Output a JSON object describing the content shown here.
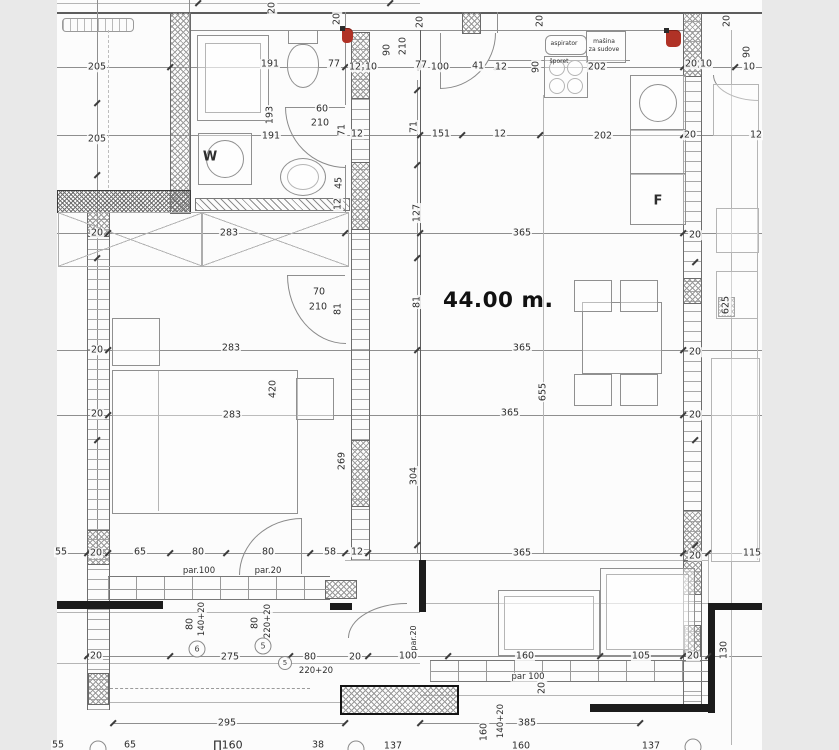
{
  "title": "apartment floor plan",
  "area": {
    "text": "44.00 m",
    "suffix": "."
  },
  "room_marks": {
    "washing_machine": "W",
    "fridge": "F"
  },
  "kitchen": {
    "hood": "aspirator",
    "dishwasher_line1": "mašina",
    "dishwasher_line2": "za sudove",
    "stove": "šporet"
  },
  "colors": {
    "paper": "#fcfcfc",
    "mat": "#e9e9e9",
    "line": "#8f8f8f",
    "wall_dark": "#1c1c1c",
    "red_mark": "#b03226"
  },
  "dimension_labels": [
    {
      "t": "20",
      "x": 272,
      "y": 8,
      "v": 1
    },
    {
      "t": "20",
      "x": 337,
      "y": 19,
      "v": 1
    },
    {
      "t": "20",
      "x": 420,
      "y": 22,
      "v": 1
    },
    {
      "t": "20",
      "x": 540,
      "y": 21,
      "v": 1
    },
    {
      "t": "20",
      "x": 727,
      "y": 21,
      "v": 1
    },
    {
      "t": "205",
      "x": 97,
      "y": 67
    },
    {
      "t": "191",
      "x": 270,
      "y": 64
    },
    {
      "t": "77",
      "x": 334,
      "y": 64
    },
    {
      "t": "12",
      "x": 355,
      "y": 67
    },
    {
      "t": "10",
      "x": 371,
      "y": 67
    },
    {
      "t": "90",
      "x": 387,
      "y": 50,
      "v": 1
    },
    {
      "t": "210",
      "x": 403,
      "y": 46,
      "v": 1
    },
    {
      "t": "77",
      "x": 421,
      "y": 65
    },
    {
      "t": "100",
      "x": 440,
      "y": 67
    },
    {
      "t": "41",
      "x": 478,
      "y": 66
    },
    {
      "t": "12",
      "x": 501,
      "y": 67
    },
    {
      "t": "90",
      "x": 536,
      "y": 67,
      "v": 1
    },
    {
      "t": "202",
      "x": 597,
      "y": 67
    },
    {
      "t": "20",
      "x": 691,
      "y": 64
    },
    {
      "t": "10",
      "x": 706,
      "y": 64
    },
    {
      "t": "90",
      "x": 747,
      "y": 52,
      "v": 1
    },
    {
      "t": "10",
      "x": 749,
      "y": 67
    },
    {
      "t": "aspirator",
      "x": 564,
      "y": 44,
      "s": 6,
      "nobg": 1
    },
    {
      "t": "mašina",
      "x": 604,
      "y": 42,
      "s": 6,
      "nobg": 1
    },
    {
      "t": "za sudove",
      "x": 604,
      "y": 50,
      "s": 6,
      "nobg": 1
    },
    {
      "t": "šporet",
      "x": 559,
      "y": 62,
      "s": 6,
      "nobg": 1
    },
    {
      "t": "60",
      "x": 322,
      "y": 109
    },
    {
      "t": "210",
      "x": 320,
      "y": 123
    },
    {
      "t": "71",
      "x": 342,
      "y": 130,
      "v": 1
    },
    {
      "t": "193",
      "x": 270,
      "y": 115,
      "v": 1
    },
    {
      "t": "191",
      "x": 271,
      "y": 136
    },
    {
      "t": "45",
      "x": 339,
      "y": 183,
      "v": 1
    },
    {
      "t": "12",
      "x": 338,
      "y": 204,
      "v": 1
    },
    {
      "t": "205",
      "x": 97,
      "y": 139
    },
    {
      "t": "12",
      "x": 357,
      "y": 134
    },
    {
      "t": "151",
      "x": 441,
      "y": 134
    },
    {
      "t": "12",
      "x": 500,
      "y": 134
    },
    {
      "t": "202",
      "x": 603,
      "y": 136
    },
    {
      "t": "20",
      "x": 690,
      "y": 135
    },
    {
      "t": "12",
      "x": 756,
      "y": 135
    },
    {
      "t": "W",
      "x": 210,
      "y": 157,
      "s": 13,
      "b": 1,
      "nobg": 1
    },
    {
      "t": "F",
      "x": 658,
      "y": 201,
      "s": 13,
      "b": 1,
      "nobg": 1
    },
    {
      "t": "71",
      "x": 414,
      "y": 127,
      "v": 1
    },
    {
      "t": "127",
      "x": 417,
      "y": 213,
      "v": 1
    },
    {
      "t": "81",
      "x": 417,
      "y": 302,
      "v": 1
    },
    {
      "t": "304",
      "x": 414,
      "y": 476,
      "v": 1
    },
    {
      "t": "269",
      "x": 342,
      "y": 461,
      "v": 1
    },
    {
      "t": "420",
      "x": 273,
      "y": 389,
      "v": 1
    },
    {
      "t": "20",
      "x": 97,
      "y": 233
    },
    {
      "t": "20",
      "x": 97,
      "y": 350
    },
    {
      "t": "20",
      "x": 97,
      "y": 414
    },
    {
      "t": "283",
      "x": 229,
      "y": 233
    },
    {
      "t": "283",
      "x": 231,
      "y": 348
    },
    {
      "t": "283",
      "x": 232,
      "y": 415
    },
    {
      "t": "70",
      "x": 319,
      "y": 292
    },
    {
      "t": "210",
      "x": 318,
      "y": 307
    },
    {
      "t": "81",
      "x": 338,
      "y": 309,
      "v": 1
    },
    {
      "t": "365",
      "x": 522,
      "y": 233
    },
    {
      "t": "365",
      "x": 522,
      "y": 348
    },
    {
      "t": "365",
      "x": 510,
      "y": 413
    },
    {
      "t": "365",
      "x": 522,
      "y": 553
    },
    {
      "t": "655",
      "x": 543,
      "y": 392,
      "v": 1
    },
    {
      "t": "20",
      "x": 695,
      "y": 235
    },
    {
      "t": "20",
      "x": 695,
      "y": 352
    },
    {
      "t": "20",
      "x": 695,
      "y": 415
    },
    {
      "t": "625",
      "x": 726,
      "y": 305,
      "v": 1
    },
    {
      "t": "55",
      "x": 61,
      "y": 552
    },
    {
      "t": "20",
      "x": 96,
      "y": 553
    },
    {
      "t": "65",
      "x": 140,
      "y": 552
    },
    {
      "t": "80",
      "x": 198,
      "y": 552
    },
    {
      "t": "80",
      "x": 268,
      "y": 552
    },
    {
      "t": "58",
      "x": 330,
      "y": 552
    },
    {
      "t": "12",
      "x": 357,
      "y": 552
    },
    {
      "t": "20",
      "x": 695,
      "y": 556
    },
    {
      "t": "115",
      "x": 752,
      "y": 553
    },
    {
      "t": "par.100",
      "x": 199,
      "y": 571,
      "s": 8.5
    },
    {
      "t": "par.20",
      "x": 268,
      "y": 571,
      "s": 8.5
    },
    {
      "t": "80",
      "x": 190,
      "y": 624,
      "v": 1
    },
    {
      "t": "140+20",
      "x": 202,
      "y": 619,
      "v": 1,
      "s": 8.5
    },
    {
      "t": "80",
      "x": 255,
      "y": 623,
      "v": 1
    },
    {
      "t": "220+20",
      "x": 268,
      "y": 621,
      "v": 1,
      "s": 8.5
    },
    {
      "t": "275",
      "x": 230,
      "y": 657
    },
    {
      "t": "80",
      "x": 310,
      "y": 657
    },
    {
      "t": "220+20",
      "x": 316,
      "y": 671,
      "s": 8.5
    },
    {
      "t": "20",
      "x": 96,
      "y": 656
    },
    {
      "t": "20",
      "x": 355,
      "y": 657
    },
    {
      "t": "100",
      "x": 408,
      "y": 656
    },
    {
      "t": "par.20",
      "x": 414,
      "y": 638,
      "v": 1,
      "s": 8
    },
    {
      "t": "160",
      "x": 525,
      "y": 656
    },
    {
      "t": "105",
      "x": 641,
      "y": 656
    },
    {
      "t": "20",
      "x": 693,
      "y": 656
    },
    {
      "t": "130",
      "x": 724,
      "y": 650,
      "v": 1
    },
    {
      "t": "par 100",
      "x": 528,
      "y": 677,
      "s": 8.5
    },
    {
      "t": "20",
      "x": 542,
      "y": 688,
      "v": 1
    },
    {
      "t": "295",
      "x": 227,
      "y": 723
    },
    {
      "t": "385",
      "x": 527,
      "y": 723
    },
    {
      "t": "140+20",
      "x": 501,
      "y": 721,
      "v": 1,
      "s": 8.5
    },
    {
      "t": "160",
      "x": 484,
      "y": 732,
      "v": 1
    },
    {
      "t": "55",
      "x": 58,
      "y": 745
    },
    {
      "t": "65",
      "x": 130,
      "y": 745
    },
    {
      "t": "∏160",
      "x": 228,
      "y": 745,
      "s": 11
    },
    {
      "t": "38",
      "x": 318,
      "y": 745
    },
    {
      "t": "137",
      "x": 393,
      "y": 746
    },
    {
      "t": "160",
      "x": 521,
      "y": 746
    },
    {
      "t": "137",
      "x": 651,
      "y": 746
    }
  ],
  "circled_marks": [
    {
      "t": "6",
      "x": 197,
      "y": 649
    },
    {
      "t": "5",
      "x": 263,
      "y": 646
    },
    {
      "t": "5",
      "x": 285,
      "y": 663,
      "small": 1
    },
    {
      "t": "",
      "x": 98,
      "y": 749
    },
    {
      "t": "",
      "x": 356,
      "y": 749
    },
    {
      "t": "",
      "x": 693,
      "y": 747
    }
  ],
  "ticks": [
    {
      "x": 170,
      "y": 67
    },
    {
      "x": 345,
      "y": 67
    },
    {
      "x": 420,
      "y": 67
    },
    {
      "x": 497,
      "y": 67
    },
    {
      "x": 683,
      "y": 67
    },
    {
      "x": 735,
      "y": 67
    },
    {
      "x": 420,
      "y": 135
    },
    {
      "x": 462,
      "y": 135
    },
    {
      "x": 540,
      "y": 135
    },
    {
      "x": 683,
      "y": 135
    },
    {
      "x": 108,
      "y": 233
    },
    {
      "x": 345,
      "y": 233
    },
    {
      "x": 420,
      "y": 233
    },
    {
      "x": 683,
      "y": 233
    },
    {
      "x": 108,
      "y": 350
    },
    {
      "x": 683,
      "y": 350
    },
    {
      "x": 108,
      "y": 415
    },
    {
      "x": 683,
      "y": 415
    },
    {
      "x": 87,
      "y": 553
    },
    {
      "x": 108,
      "y": 553
    },
    {
      "x": 170,
      "y": 553
    },
    {
      "x": 226,
      "y": 553
    },
    {
      "x": 310,
      "y": 553
    },
    {
      "x": 345,
      "y": 553
    },
    {
      "x": 368,
      "y": 553
    },
    {
      "x": 683,
      "y": 553
    },
    {
      "x": 708,
      "y": 553
    },
    {
      "x": 87,
      "y": 656
    },
    {
      "x": 170,
      "y": 656
    },
    {
      "x": 290,
      "y": 656
    },
    {
      "x": 368,
      "y": 656
    },
    {
      "x": 448,
      "y": 656
    },
    {
      "x": 600,
      "y": 656
    },
    {
      "x": 683,
      "y": 656
    },
    {
      "x": 708,
      "y": 656
    },
    {
      "x": 113,
      "y": 723
    },
    {
      "x": 345,
      "y": 723
    },
    {
      "x": 420,
      "y": 723
    },
    {
      "x": 640,
      "y": 723
    },
    {
      "x": 97,
      "y": 103
    },
    {
      "x": 97,
      "y": 175
    },
    {
      "x": 97,
      "y": 258
    },
    {
      "x": 97,
      "y": 440
    },
    {
      "x": 417,
      "y": 90
    },
    {
      "x": 417,
      "y": 165
    },
    {
      "x": 417,
      "y": 258
    },
    {
      "x": 417,
      "y": 350
    },
    {
      "x": 417,
      "y": 545
    },
    {
      "x": 695,
      "y": 262
    },
    {
      "x": 695,
      "y": 440
    },
    {
      "x": 695,
      "y": 545
    },
    {
      "x": 198,
      "y": 3
    },
    {
      "x": 390,
      "y": 3
    }
  ]
}
